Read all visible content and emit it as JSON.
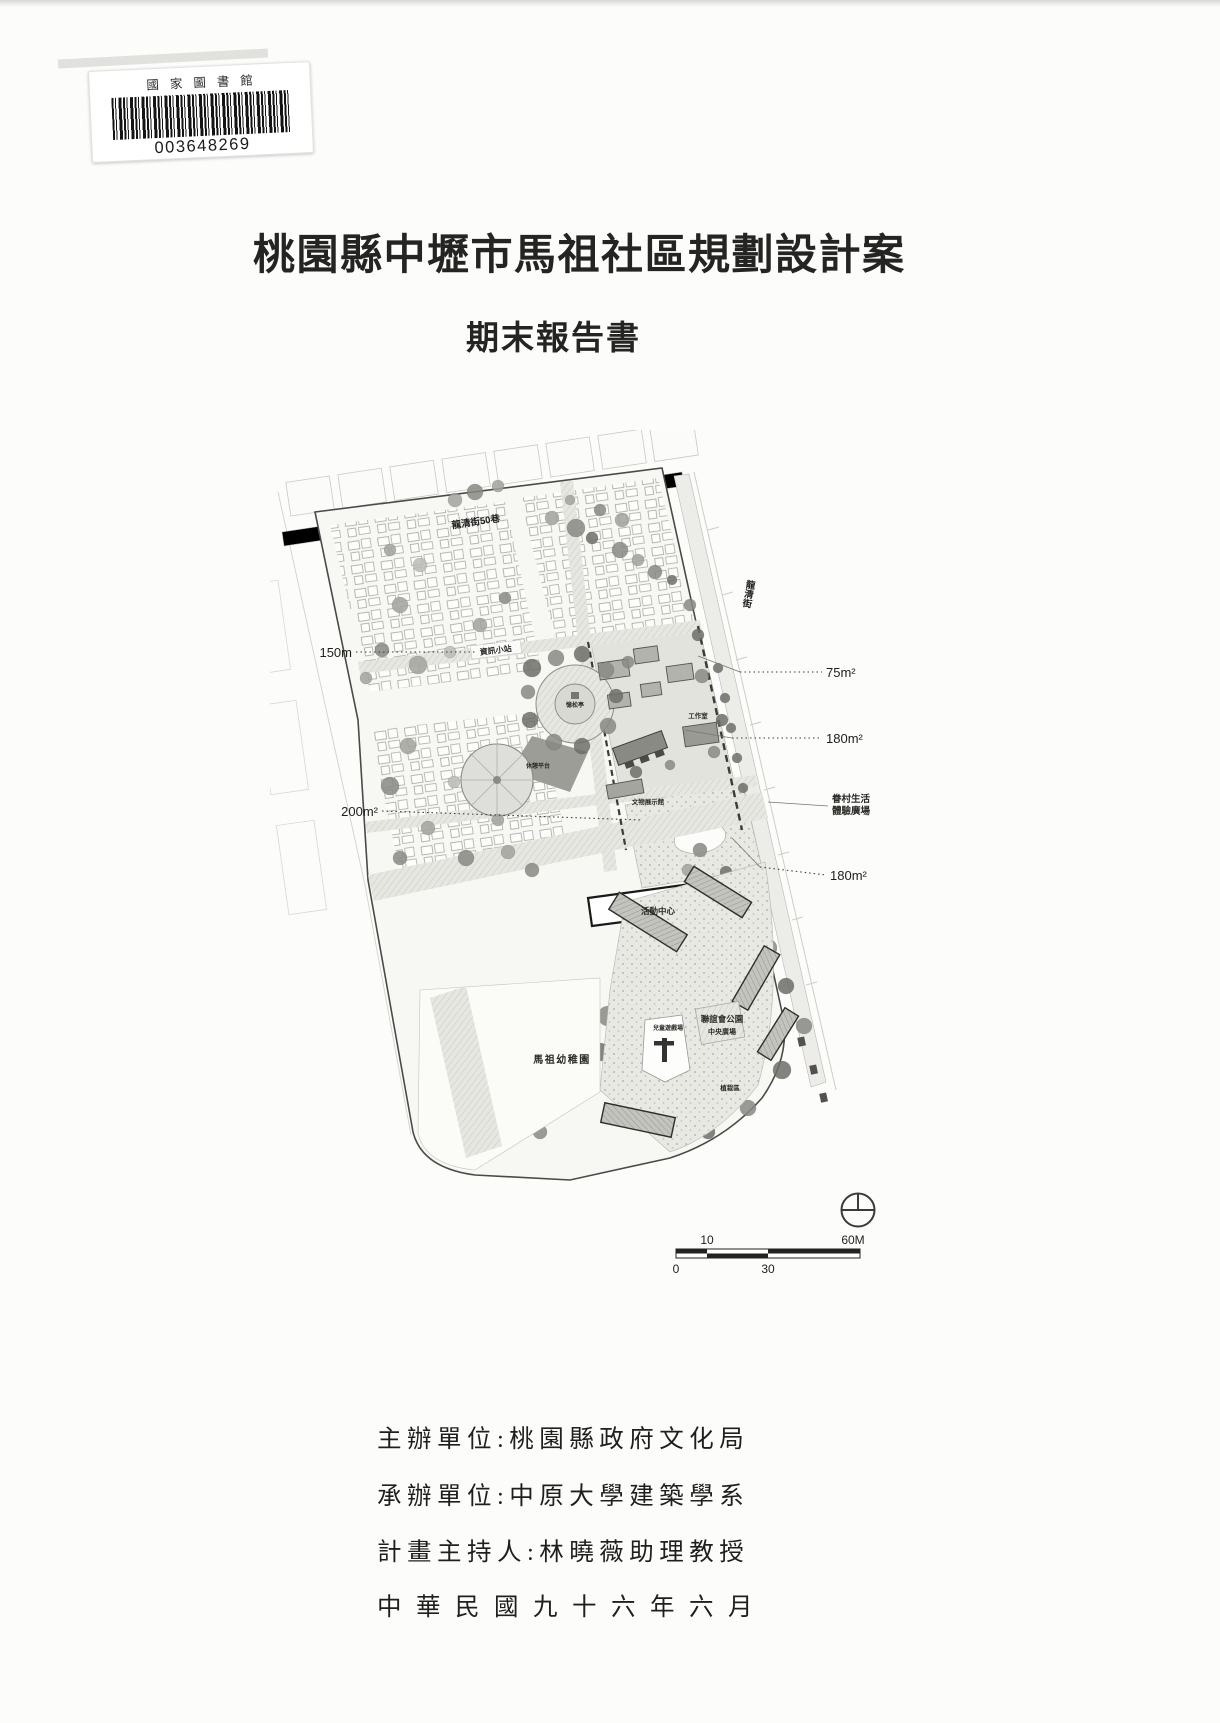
{
  "barcode_sticker": {
    "library_name": "國家圖書館",
    "number": "003648269"
  },
  "cover": {
    "title": "桃園縣中壢市馬祖社區規劃設計案",
    "subtitle": "期末報告書",
    "credits": [
      {
        "text": "主辦單位:桃園縣政府文化局"
      },
      {
        "text": "承辦單位:中原大學建築學系"
      },
      {
        "text": "計畫主持人:林曉薇助理教授"
      },
      {
        "text": "中華民國九十六年六月"
      }
    ]
  },
  "siteplan": {
    "streets": {
      "top": "龍清街50巷",
      "right": "龍清街"
    },
    "labels": {
      "info_station": "資訊小站",
      "pavilion": "憶松亭",
      "workshop": "工作室",
      "rest_platform": "休憩平台",
      "exhibition_hall": "文物展示館",
      "activity_center": "活動中心",
      "kindergarten": "馬祖幼稚園",
      "park": "聯誼會公園",
      "central_plaza": "中央廣場",
      "children_playground": "兒童遊戲場",
      "planting_area": "植栽區"
    },
    "annotations": {
      "left_150": "150m",
      "left_200": "200m²",
      "right_75": "75m²",
      "right_180_upper": "180m²",
      "village_plaza_line1": "眷村生活",
      "village_plaza_line2": "體驗廣場",
      "right_180_lower": "180m²"
    },
    "scalebar": {
      "top_left": "10",
      "top_right": "60M",
      "bottom_left": "0",
      "bottom_middle": "30"
    }
  }
}
